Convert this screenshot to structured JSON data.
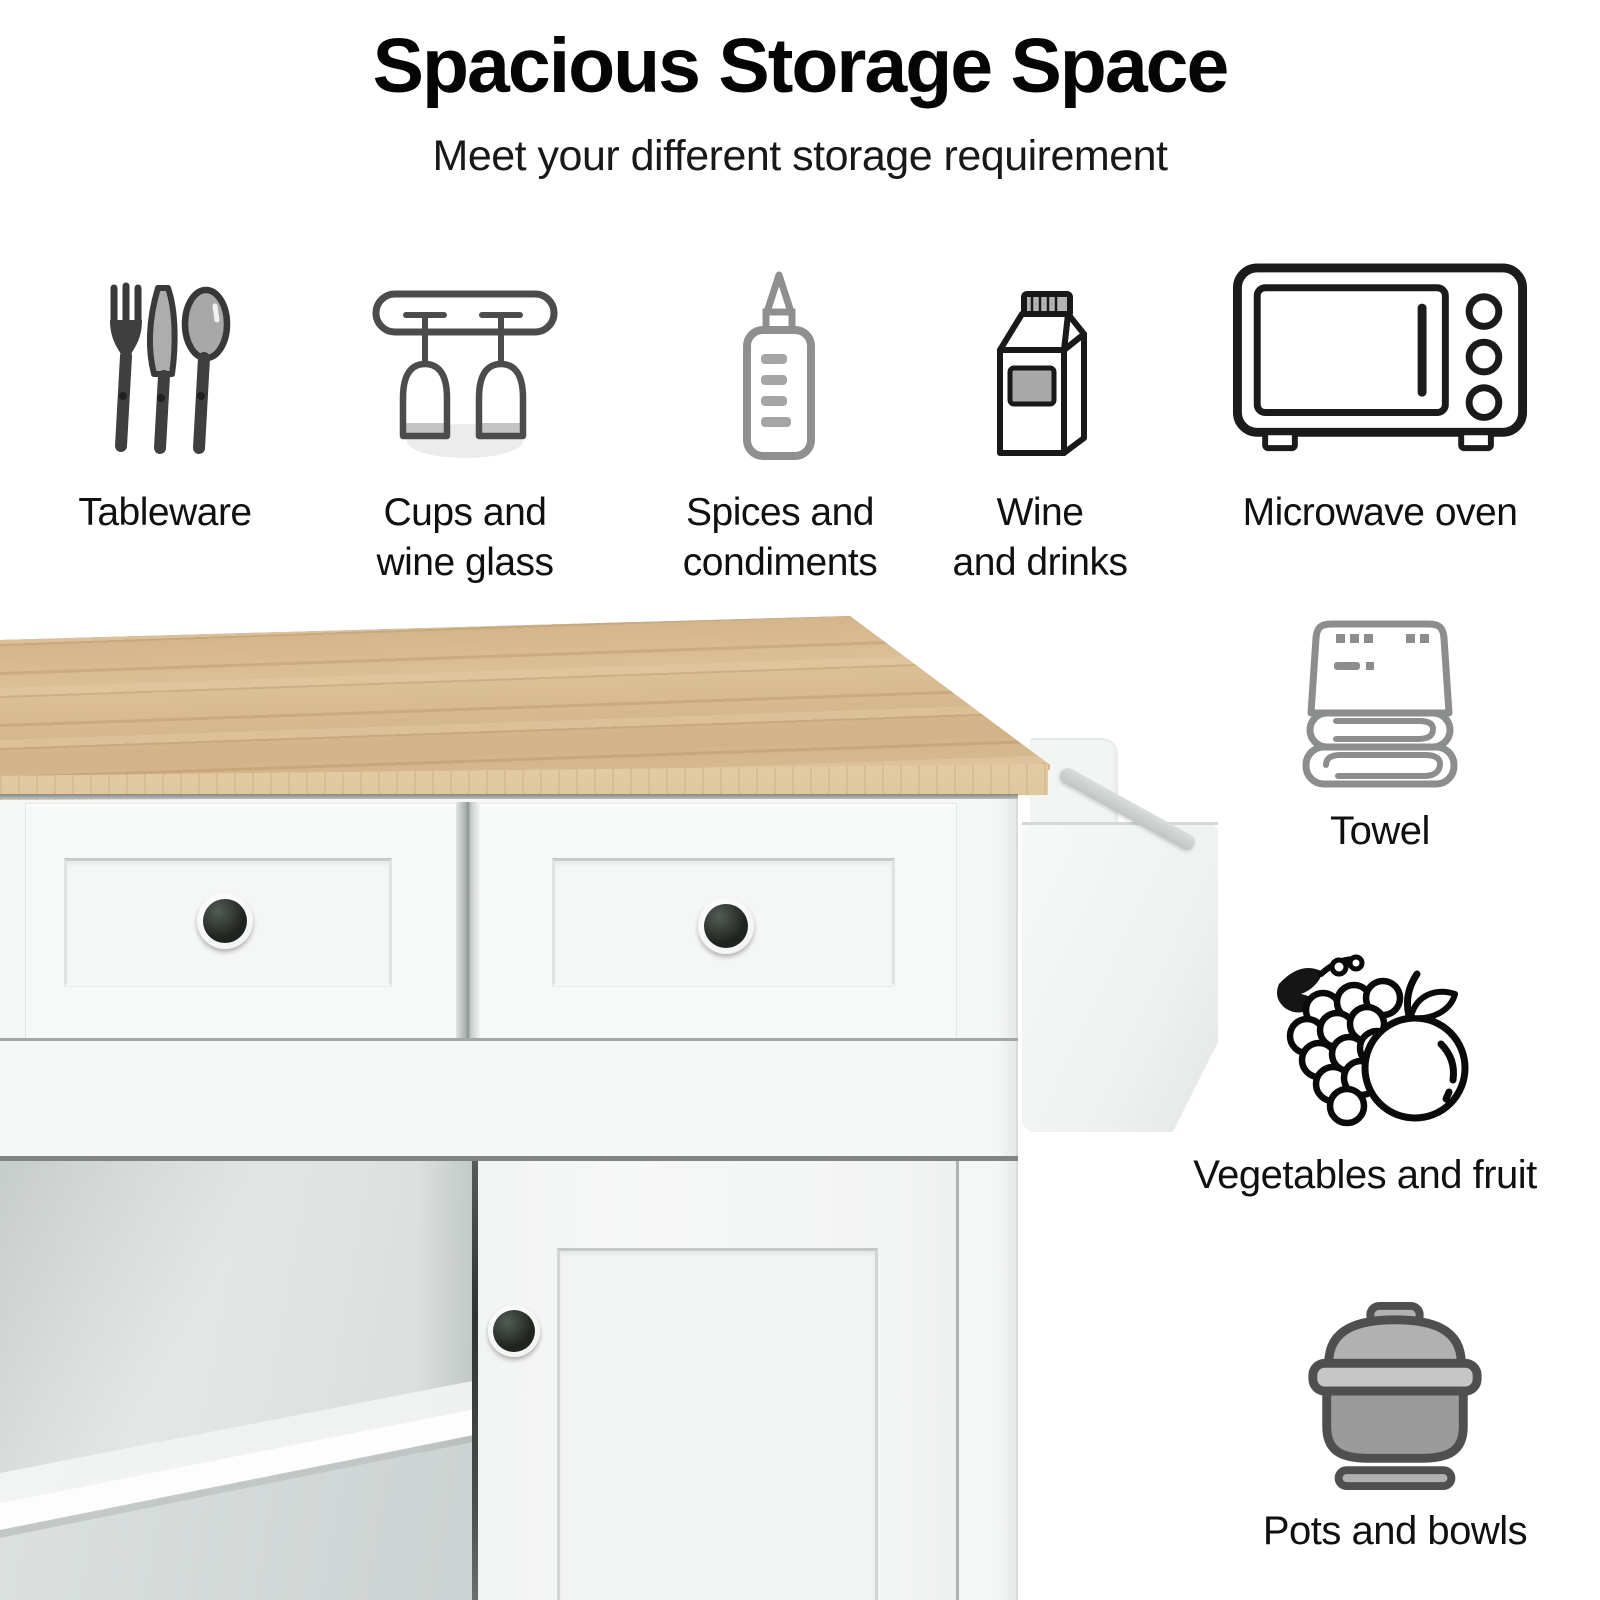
{
  "header": {
    "title": "Spacious Storage Space",
    "subtitle": "Meet your different storage requirement"
  },
  "storage_items_top": [
    {
      "icon": "cutlery-icon",
      "line1": "Tableware",
      "line2": ""
    },
    {
      "icon": "wine-glass-rack-icon",
      "line1": "Cups and",
      "line2": "wine glass"
    },
    {
      "icon": "squeeze-bottle-icon",
      "line1": "Spices and",
      "line2": "condiments"
    },
    {
      "icon": "drink-carton-icon",
      "line1": "Wine",
      "line2": "and drinks"
    },
    {
      "icon": "microwave-icon",
      "line1": "Microwave oven",
      "line2": ""
    }
  ],
  "storage_items_side": [
    {
      "icon": "folded-towel-icon",
      "label": "Towel"
    },
    {
      "icon": "grapes-and-orange-icon",
      "label": "Vegetables and fruit"
    },
    {
      "icon": "cooking-pot-icon",
      "label": "Pots and bowls"
    }
  ],
  "product_photo": {
    "name": "white kitchen cart with natural wood top",
    "visible_parts": [
      "natural wood countertop",
      "two drawers with black knobs",
      "open shelf compartment",
      "cabinet door with black knob",
      "side rack with towel bar"
    ],
    "colors": {
      "wood_top": "#d6b98f",
      "cabinet": "#f5f6f6",
      "knobs": "#22261f",
      "interior": "#e2e6e5",
      "towel_bar": "#c9cecc",
      "background": "#ffffff",
      "text": "#0d0d0d"
    }
  }
}
